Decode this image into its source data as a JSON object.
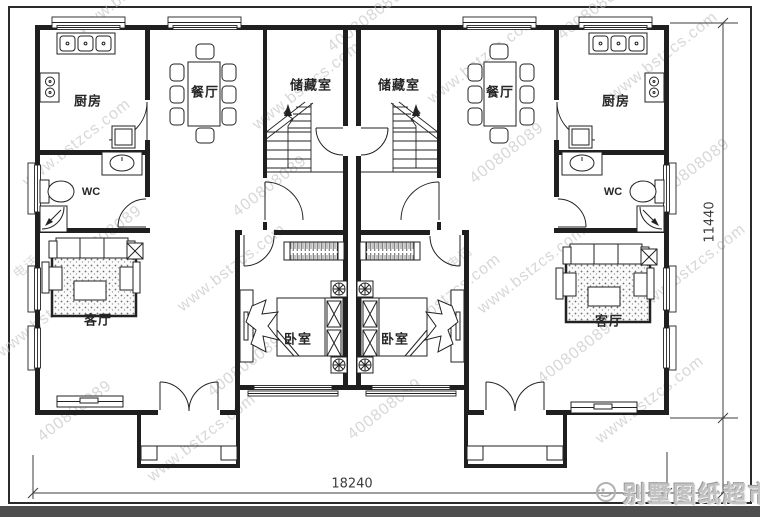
{
  "rooms": {
    "kitchen": "厨房",
    "dining": "餐厅",
    "storage": "储藏室",
    "wc": "WC",
    "living": "客厅",
    "bedroom": "卧室"
  },
  "dimensions": {
    "width": "18240",
    "height": "11440"
  },
  "watermark": {
    "site": "www.bstzcs.com",
    "number": "400808089",
    "phone": "电话"
  },
  "logo": {
    "brand": "别墅图纸超市"
  },
  "colors": {
    "line": "#1f1f1f",
    "watermark": "#bdbdbd",
    "bottom_bar": "#4e4e50"
  }
}
